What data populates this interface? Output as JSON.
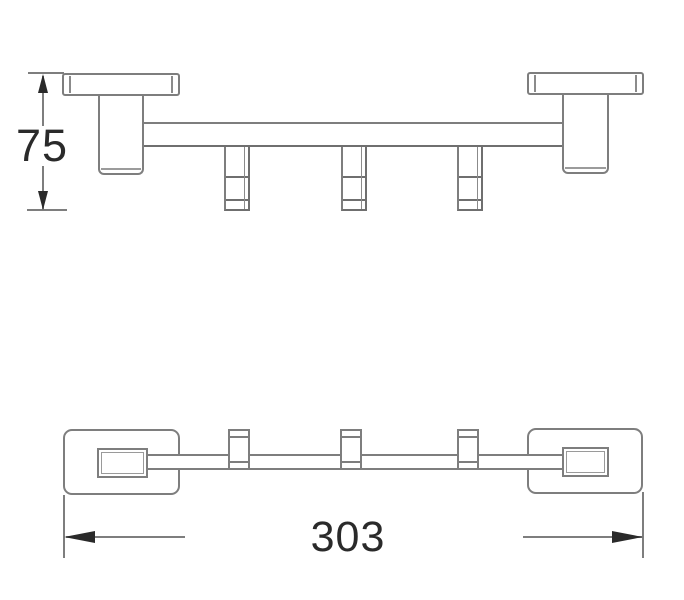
{
  "drawing": {
    "background": "#ffffff",
    "line_color": "#7e7e7e",
    "annotation_color": "#2a2a2a",
    "hook_count": 3,
    "dimensions": {
      "height": {
        "label": "75",
        "orientation": "vertical",
        "view": "side-elevation"
      },
      "length": {
        "label": "303",
        "orientation": "horizontal",
        "view": "plan"
      }
    }
  }
}
